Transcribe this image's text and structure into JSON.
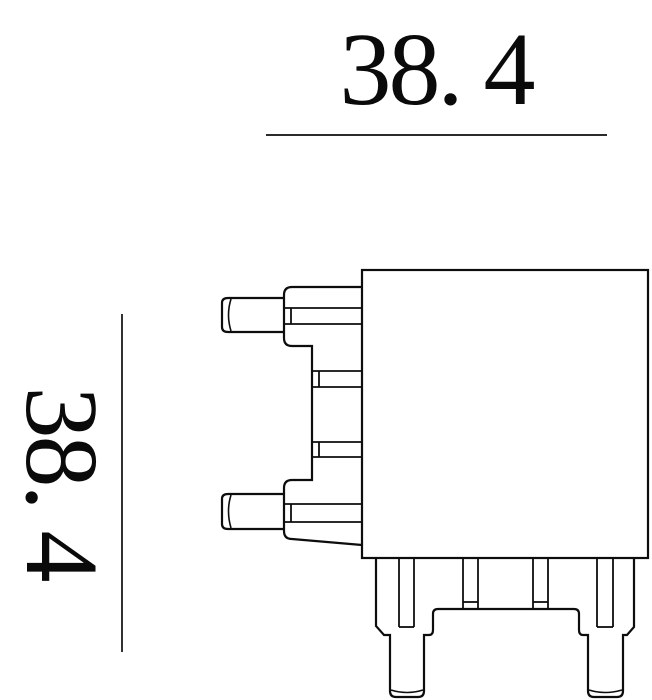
{
  "page": {
    "background_color": "#ffffff",
    "line_color": "#0d0d0d"
  },
  "dimensions": {
    "horizontal": {
      "label": "38. 4"
    },
    "vertical": {
      "label": "38. 4"
    }
  },
  "drawing": {
    "description-visible-parts": "square component body with left flange, two side pins, two middle tabs, bottom feet with two bottom pins"
  }
}
